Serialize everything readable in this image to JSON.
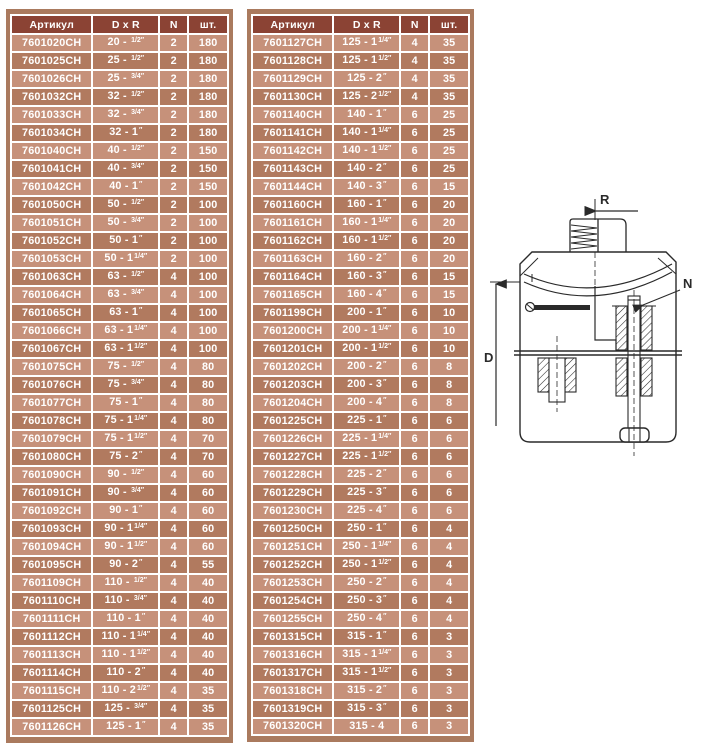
{
  "page": {
    "background": "#ffffff"
  },
  "colors": {
    "header_bg": "#8b4334",
    "row_light": "#c6917a",
    "row_dark": "#b17a5f",
    "border_brown": "#aa7a5e",
    "cell_text": "#ffffff",
    "diagram_line": "#2a2a2a"
  },
  "tables": [
    {
      "id": "left",
      "headers": [
        "Артикул",
        "D x R",
        "N",
        "шт."
      ],
      "rows": [
        [
          "7601020CH",
          "20 - ",
          "1/2″",
          "2",
          "180"
        ],
        [
          "7601025CH",
          "25 - ",
          "1/2″",
          "2",
          "180"
        ],
        [
          "7601026CH",
          "25 - ",
          "3/4″",
          "2",
          "180"
        ],
        [
          "7601032CH",
          "32 - ",
          "1/2″",
          "2",
          "180"
        ],
        [
          "7601033CH",
          "32 - ",
          "3/4″",
          "2",
          "180"
        ],
        [
          "7601034CH",
          "32 - 1",
          "″",
          "2",
          "180"
        ],
        [
          "7601040CH",
          "40 - ",
          "1/2″",
          "2",
          "150"
        ],
        [
          "7601041CH",
          "40 - ",
          "3/4″",
          "2",
          "150"
        ],
        [
          "7601042CH",
          "40 - 1",
          "″",
          "2",
          "150"
        ],
        [
          "7601050CH",
          "50 - ",
          "1/2″",
          "2",
          "100"
        ],
        [
          "7601051CH",
          "50 - ",
          "3/4″",
          "2",
          "100"
        ],
        [
          "7601052CH",
          "50 - 1",
          "″",
          "2",
          "100"
        ],
        [
          "7601053CH",
          "50 - 1",
          "1/4″",
          "2",
          "100"
        ],
        [
          "7601063CH",
          "63 - ",
          "1/2″",
          "4",
          "100"
        ],
        [
          "7601064CH",
          "63 - ",
          "3/4″",
          "4",
          "100"
        ],
        [
          "7601065CH",
          "63 - 1",
          "″",
          "4",
          "100"
        ],
        [
          "7601066CH",
          "63 - 1",
          "1/4″",
          "4",
          "100"
        ],
        [
          "7601067CH",
          "63 - 1",
          "1/2″",
          "4",
          "100"
        ],
        [
          "7601075CH",
          "75 - ",
          "1/2″",
          "4",
          "80"
        ],
        [
          "7601076CH",
          "75 - ",
          "3/4″",
          "4",
          "80"
        ],
        [
          "7601077CH",
          "75 - 1",
          "″",
          "4",
          "80"
        ],
        [
          "7601078CH",
          "75 - 1",
          "1/4″",
          "4",
          "80"
        ],
        [
          "7601079CH",
          "75 - 1",
          "1/2″",
          "4",
          "70"
        ],
        [
          "7601080CH",
          "75 - 2",
          "″",
          "4",
          "70"
        ],
        [
          "7601090CH",
          "90 - ",
          "1/2″",
          "4",
          "60"
        ],
        [
          "7601091CH",
          "90 - ",
          "3/4″",
          "4",
          "60"
        ],
        [
          "7601092CH",
          "90 - 1",
          "″",
          "4",
          "60"
        ],
        [
          "7601093CH",
          "90 - 1",
          "1/4″",
          "4",
          "60"
        ],
        [
          "7601094CH",
          "90 - 1",
          "1/2″",
          "4",
          "60"
        ],
        [
          "7601095CH",
          "90 - 2",
          "″",
          "4",
          "55"
        ],
        [
          "7601109CH",
          "110 - ",
          "1/2″",
          "4",
          "40"
        ],
        [
          "7601110CH",
          "110 - ",
          "3/4″",
          "4",
          "40"
        ],
        [
          "7601111CH",
          "110 - 1",
          "″",
          "4",
          "40"
        ],
        [
          "7601112CH",
          "110 - 1",
          "1/4″",
          "4",
          "40"
        ],
        [
          "7601113CH",
          "110 - 1",
          "1/2″",
          "4",
          "40"
        ],
        [
          "7601114CH",
          "110 - 2",
          "″",
          "4",
          "40"
        ],
        [
          "7601115CH",
          "110 - 2",
          "1/2″",
          "4",
          "35"
        ],
        [
          "7601125CH",
          "125 - ",
          "3/4″",
          "4",
          "35"
        ],
        [
          "7601126CH",
          "125 - 1",
          "″",
          "4",
          "35"
        ]
      ]
    },
    {
      "id": "right",
      "headers": [
        "Артикул",
        "D x R",
        "N",
        "шт."
      ],
      "rows": [
        [
          "7601127CH",
          "125 - 1",
          "1/4″",
          "4",
          "35"
        ],
        [
          "7601128CH",
          "125 - 1",
          "1/2″",
          "4",
          "35"
        ],
        [
          "7601129CH",
          "125 - 2",
          "″",
          "4",
          "35"
        ],
        [
          "7601130CH",
          "125 - 2",
          "1/2″",
          "4",
          "35"
        ],
        [
          "7601140CH",
          "140 - 1",
          "″",
          "6",
          "25"
        ],
        [
          "7601141CH",
          "140 - 1",
          "1/4″",
          "6",
          "25"
        ],
        [
          "7601142CH",
          "140 - 1",
          "1/2″",
          "6",
          "25"
        ],
        [
          "7601143CH",
          "140 - 2",
          "″",
          "6",
          "25"
        ],
        [
          "7601144CH",
          "140 - 3",
          "″",
          "6",
          "15"
        ],
        [
          "7601160CH",
          "160 - 1",
          "″",
          "6",
          "20"
        ],
        [
          "7601161CH",
          "160 - 1",
          "1/4″",
          "6",
          "20"
        ],
        [
          "7601162CH",
          "160 - 1",
          "1/2″",
          "6",
          "20"
        ],
        [
          "7601163CH",
          "160 - 2",
          "″",
          "6",
          "20"
        ],
        [
          "7601164CH",
          "160 - 3",
          "″",
          "6",
          "15"
        ],
        [
          "7601165CH",
          "160 - 4",
          "″",
          "6",
          "15"
        ],
        [
          "7601199CH",
          "200 - 1",
          "″",
          "6",
          "10"
        ],
        [
          "7601200CH",
          "200 - 1",
          "1/4″",
          "6",
          "10"
        ],
        [
          "7601201CH",
          "200 - 1",
          "1/2″",
          "6",
          "10"
        ],
        [
          "7601202CH",
          "200 - 2",
          "″",
          "6",
          "8"
        ],
        [
          "7601203CH",
          "200 - 3",
          "″",
          "6",
          "8"
        ],
        [
          "7601204CH",
          "200 - 4",
          "″",
          "6",
          "8"
        ],
        [
          "7601225CH",
          "225 - 1",
          "″",
          "6",
          "6"
        ],
        [
          "7601226CH",
          "225 - 1",
          "1/4″",
          "6",
          "6"
        ],
        [
          "7601227CH",
          "225 - 1",
          "1/2″",
          "6",
          "6"
        ],
        [
          "7601228CH",
          "225 - 2",
          "″",
          "6",
          "6"
        ],
        [
          "7601229CH",
          "225 - 3",
          "″",
          "6",
          "6"
        ],
        [
          "7601230CH",
          "225 - 4",
          "″",
          "6",
          "6"
        ],
        [
          "7601250CH",
          "250 - 1",
          "″",
          "6",
          "4"
        ],
        [
          "7601251CH",
          "250 - 1",
          "1/4″",
          "6",
          "4"
        ],
        [
          "7601252CH",
          "250 - 1",
          "1/2″",
          "6",
          "4"
        ],
        [
          "7601253CH",
          "250 - 2",
          "″",
          "6",
          "4"
        ],
        [
          "7601254CH",
          "250 - 3",
          "″",
          "6",
          "4"
        ],
        [
          "7601255CH",
          "250 - 4",
          "″",
          "6",
          "4"
        ],
        [
          "7601315CH",
          "315 - 1",
          "″",
          "6",
          "3"
        ],
        [
          "7601316CH",
          "315 - 1",
          "1/4″",
          "6",
          "3"
        ],
        [
          "7601317CH",
          "315 - 1",
          "1/2″",
          "6",
          "3"
        ],
        [
          "7601318CH",
          "315 - 2",
          "″",
          "6",
          "3"
        ],
        [
          "7601319CH",
          "315 - 3",
          "″",
          "6",
          "3"
        ],
        [
          "7601320CH",
          "315 - 4",
          "",
          "6",
          "3"
        ]
      ]
    }
  ],
  "diagram": {
    "labels": {
      "r": "R",
      "n": "N",
      "d": "D"
    }
  }
}
